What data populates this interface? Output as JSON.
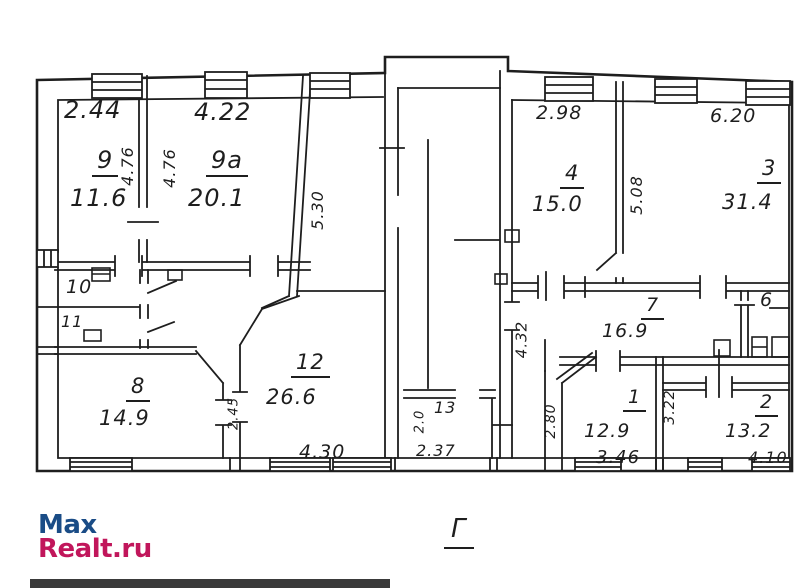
{
  "plan": {
    "rooms": {
      "r9": {
        "number": "9",
        "area": "11.6"
      },
      "r9a": {
        "number": "9a",
        "area": "20.1"
      },
      "r10": {
        "number": "10"
      },
      "r11": {
        "number": "11"
      },
      "r8": {
        "number": "8",
        "area": "14.9"
      },
      "r12": {
        "number": "12",
        "area": "26.6"
      },
      "r13": {
        "number": "13"
      },
      "r4": {
        "number": "4",
        "area": "15.0"
      },
      "r3": {
        "number": "3",
        "area": "31.4"
      },
      "r7": {
        "number": "7",
        "area": "16.9"
      },
      "r6": {
        "number": "6"
      },
      "r1": {
        "number": "1",
        "area": "12.9"
      },
      "r2": {
        "number": "2",
        "area": "13.2"
      }
    },
    "dimensions": {
      "room9_width": "2.44",
      "room9a_width": "4.22",
      "room9_depth": "4.76",
      "room9a_depth": "4.76",
      "corridor_length": "5.30",
      "room4_width": "2.98",
      "room3_width": "6.20",
      "room4_depth": "5.08",
      "hall_length": "4.32",
      "room1_left": "2.80",
      "room1_width": "3.46",
      "room2_depth": "3.22",
      "room12_width": "4.30",
      "room13_width": "2.37",
      "room13_depth": "2.0",
      "room8_niche": "2.45",
      "room2_width": "4.10"
    },
    "section_label": "Г"
  },
  "watermark": {
    "line1": "Max",
    "line2": "Realt.ru",
    "line1_color": "#1a4c86",
    "line2_color": "#c1165b"
  },
  "ink_color": "#1e1e1e"
}
